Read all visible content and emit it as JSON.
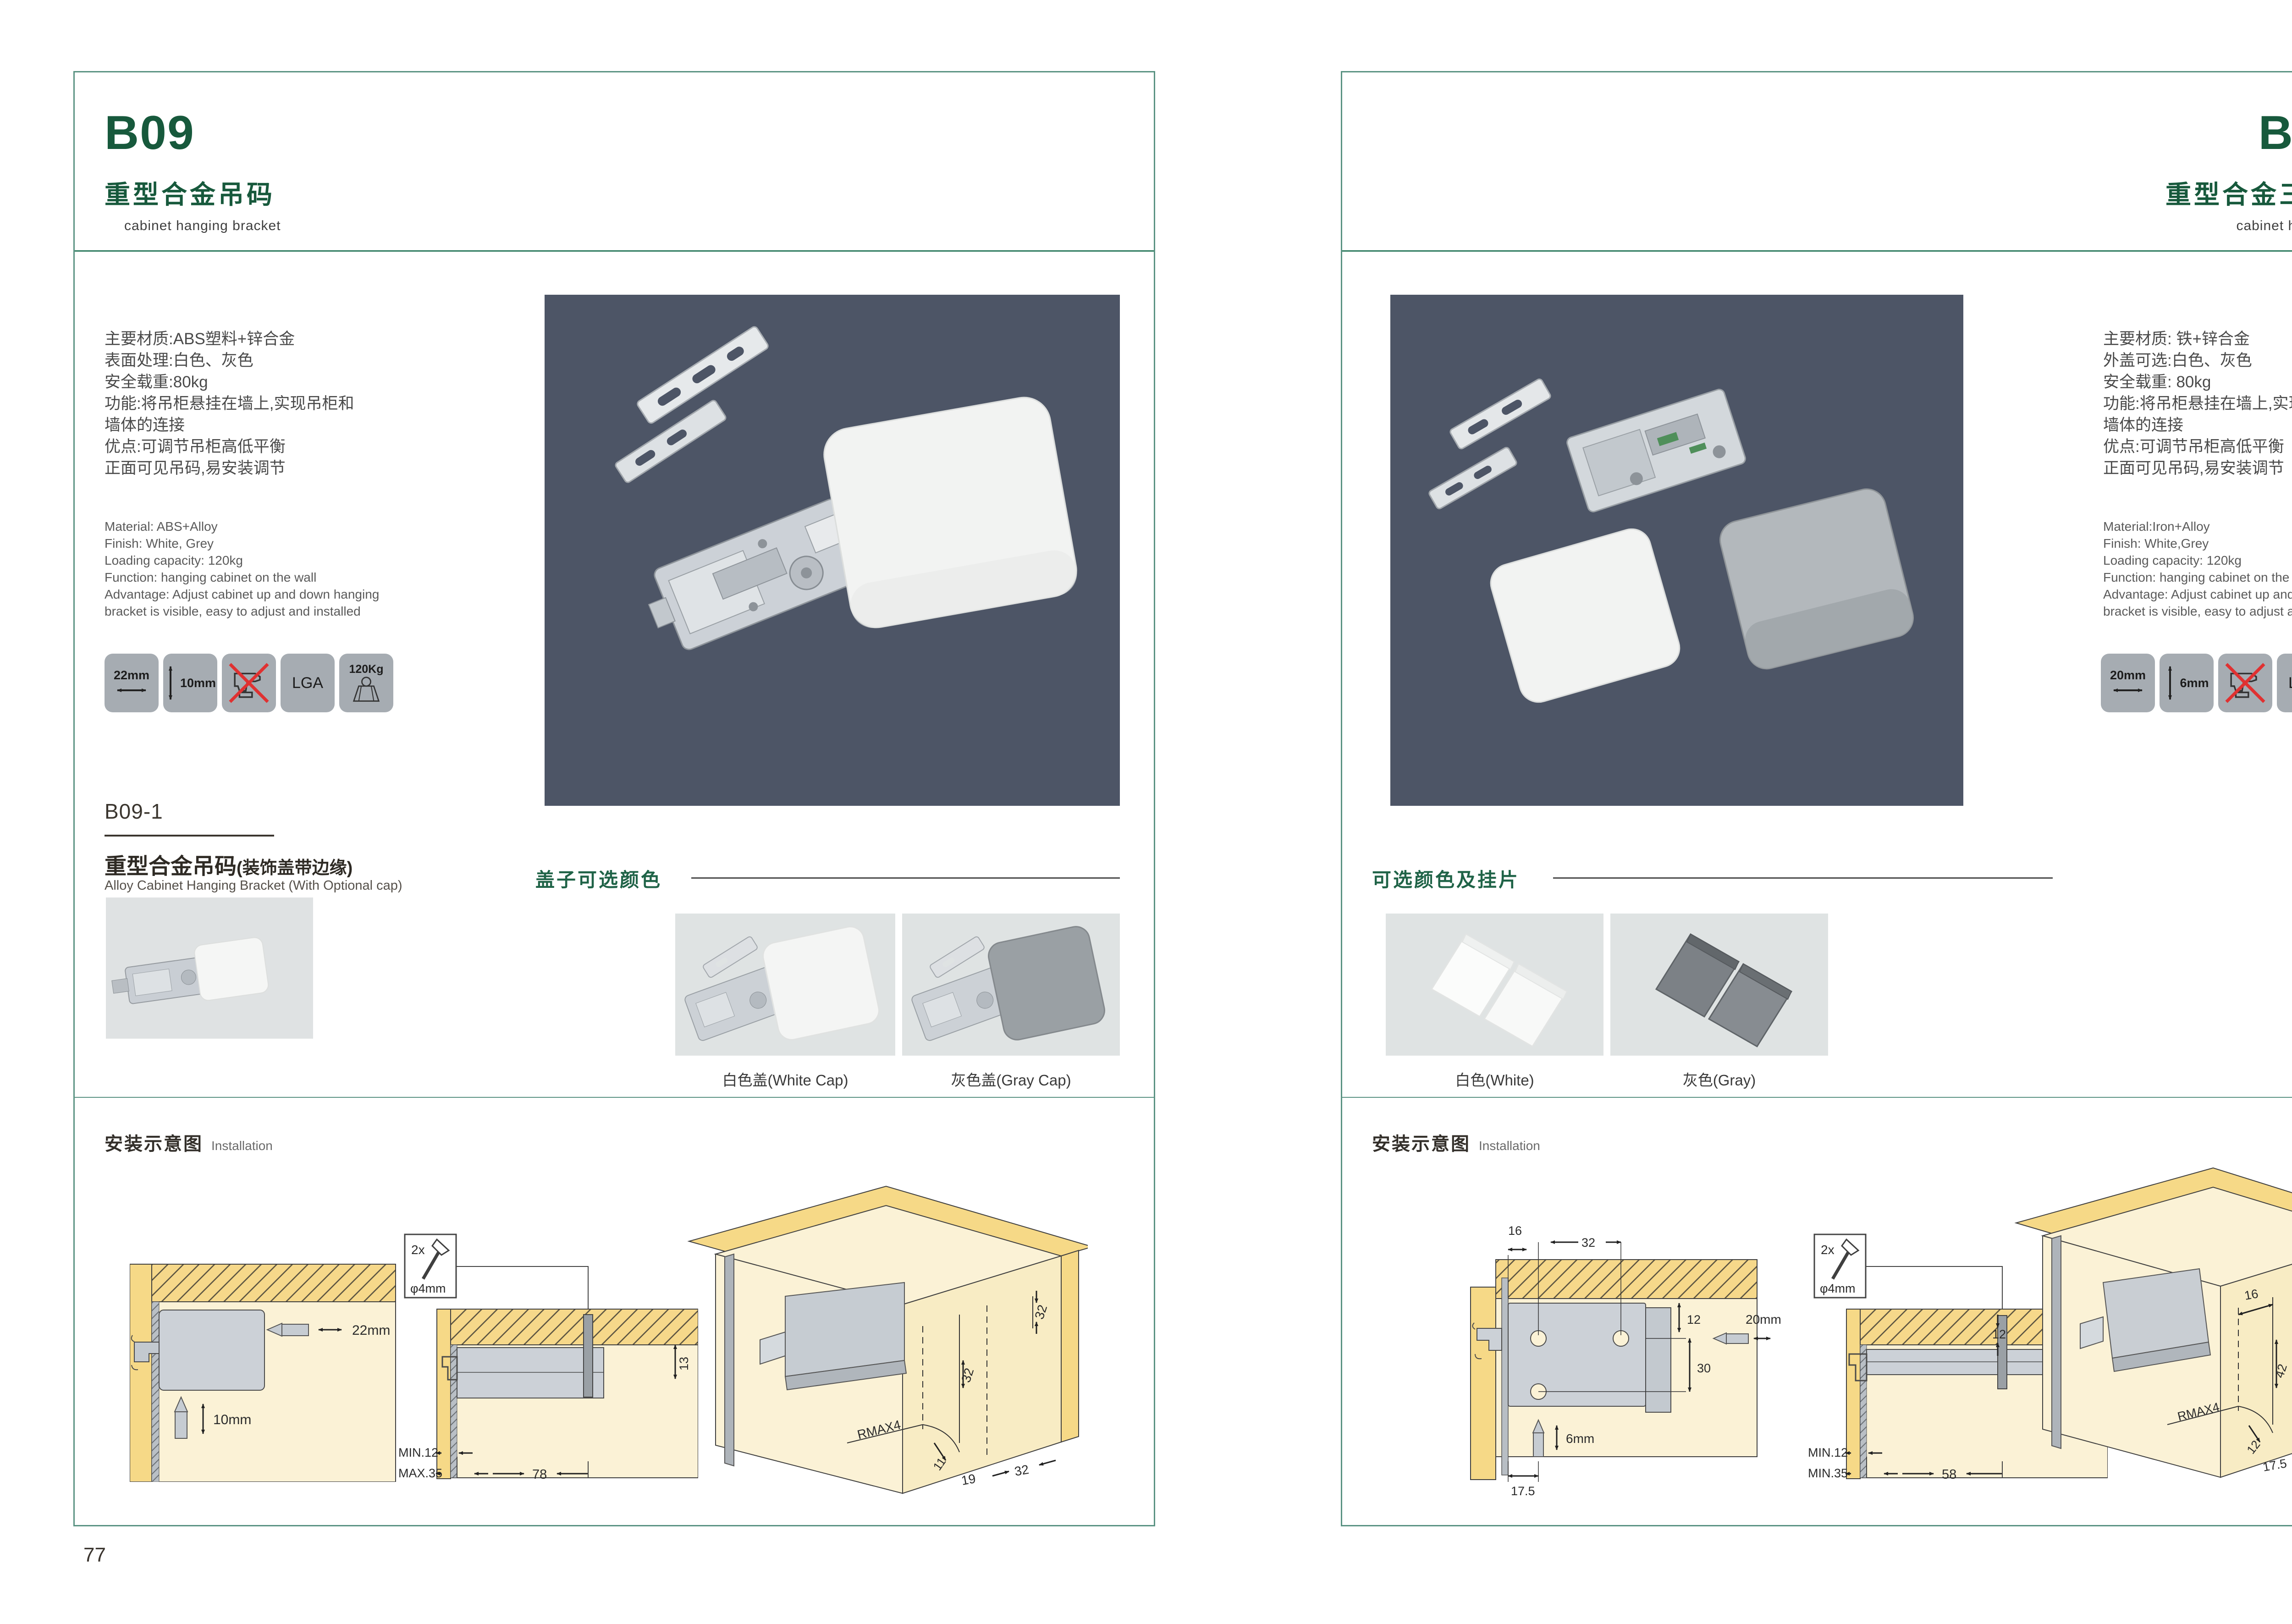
{
  "doc": {
    "accent_green": "#17593c",
    "rule_green": "#2c7a5e",
    "border_teal": "#5b9383"
  },
  "pages": {
    "left": {
      "code": "B09",
      "title_cn": "重型合金吊码",
      "subtitle_en": "cabinet hanging bracket",
      "specs_cn": [
        "主要材质:ABS塑料+锌合金",
        "表面处理:白色、灰色",
        "安全载重:80kg",
        "功能:将吊柜悬挂在墙上,实现吊柜和",
        "墙体的连接",
        "优点:可调节吊柜高低平衡",
        "正面可见吊码,易安装调节"
      ],
      "specs_en": [
        "Material: ABS+Alloy",
        "Finish: White, Grey",
        "Loading capacity: 120kg",
        "Function: hanging cabinet on the wall",
        "Advantage: Adjust cabinet up and down hanging",
        "bracket is visible, easy to adjust and installed"
      ],
      "icons": {
        "width": "22mm",
        "height": "10mm",
        "cert": "LGA",
        "load": "120Kg"
      },
      "sub_section": {
        "code": "B09-1",
        "title_cn": "重型合金吊码",
        "title_cn_note": "(装饰盖带边缘)",
        "title_en": "Alloy Cabinet Hanging Bracket (With Optional cap)"
      },
      "caps": {
        "heading": "盖子可选颜色",
        "white_label": "白色盖(White Cap)",
        "gray_label": "灰色盖(Gray Cap)"
      },
      "install": {
        "heading_cn": "安装示意图",
        "heading_en": "Installation",
        "a": {
          "d_width": "22mm",
          "d_height": "10mm"
        },
        "b": {
          "qty": "2x",
          "dia": "φ4mm",
          "thick": "13",
          "min": "MIN.12",
          "max": "MAX.35",
          "depth": "78"
        },
        "c": {
          "s1": "32",
          "s2": "32",
          "r": "RMAX4",
          "e1": "11",
          "e2": "19",
          "e3": "32"
        }
      },
      "page_no": "77"
    },
    "right": {
      "code": "B09-3",
      "title_cn": "重型合金三孔吊码",
      "subtitle_en": "cabinet hanging bracket",
      "specs_cn": [
        "主要材质: 铁+锌合金",
        "外盖可选:白色、灰色",
        "安全载重: 80kg",
        "功能:将吊柜悬挂在墙上,实现吊柜和",
        "墙体的连接",
        "优点:可调节吊柜高低平衡",
        "正面可见吊码,易安装调节"
      ],
      "specs_en": [
        "Material:Iron+Alloy",
        "Finish: White,Grey",
        "Loading capacity: 120kg",
        "Function: hanging cabinet on the wall",
        "Advantage: Adjust cabinet up and down hanging",
        "bracket is visible, easy to adjust and installed"
      ],
      "icons": {
        "width": "20mm",
        "height": "6mm",
        "cert": "LGA",
        "load": "120Kg"
      },
      "caps": {
        "heading": "可选颜色及挂片",
        "white_label": "白色(White)",
        "gray_label": "灰色(Gray)"
      },
      "install": {
        "heading_cn": "安装示意图",
        "heading_en": "Installation",
        "a": {
          "d1": "16",
          "d2": "32",
          "d3": "12",
          "d4": "30",
          "d5": "20mm",
          "d6": "6mm",
          "d7": "17.5"
        },
        "b": {
          "qty": "2x",
          "dia": "φ4mm",
          "thick": "12",
          "min": "MIN.12",
          "min2": "MIN.35",
          "depth": "58"
        },
        "c": {
          "d0": "12",
          "d1": "16",
          "d2": "42",
          "r": "RMAX4",
          "d3": "12",
          "d4": "17.5",
          "d5": "32",
          "d6": "12"
        }
      },
      "page_no": "78"
    }
  }
}
